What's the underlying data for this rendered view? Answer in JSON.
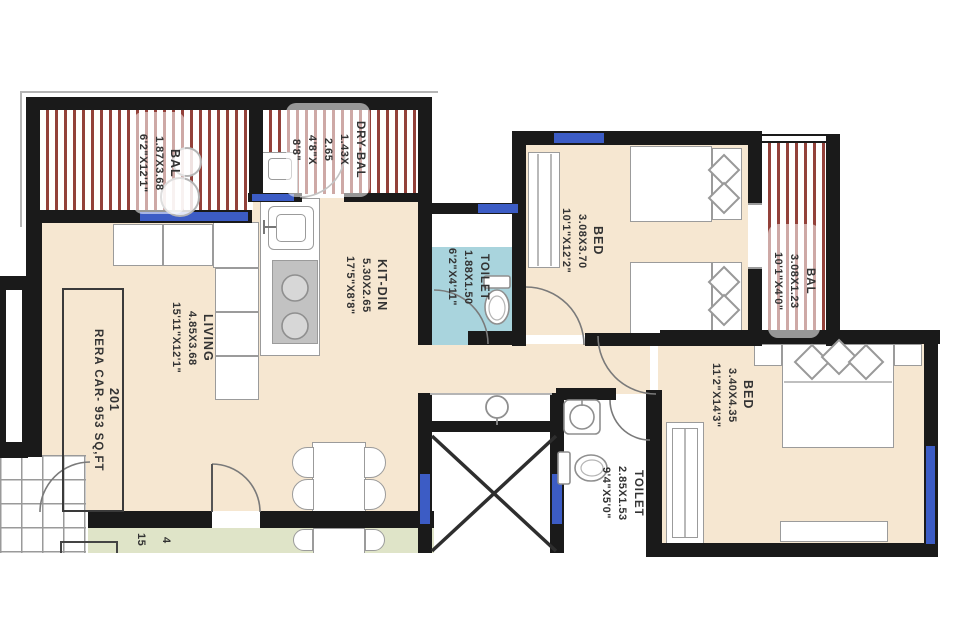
{
  "plan": {
    "unit_box": {
      "number": "201",
      "area": "RERA CAR- 953 SQ,FT"
    },
    "rooms": {
      "balcony_left": {
        "name": "BAL",
        "dim_m": "1.87X3.68",
        "dim_ft": "6'2\"X12'1\""
      },
      "dry_balcony": {
        "name": "DRY-BAL",
        "dim_m_a": "1.43X",
        "dim_m_b": "2.65",
        "dim_ft_a": "4'8\"X",
        "dim_ft_b": "8'8\""
      },
      "living": {
        "name": "LIVING",
        "dim_m": "4.85X3.68",
        "dim_ft": "15'11\"X12'1\""
      },
      "kitchen_dining": {
        "name": "KIT-DIN",
        "dim_m": "5.30X2.65",
        "dim_ft": "17'5\"X8'8\""
      },
      "toilet_common": {
        "name": "TOILET",
        "dim_m": "1.88X1.50",
        "dim_ft": "6'2\"X4'11\""
      },
      "bed_top": {
        "name": "BED",
        "dim_m": "3.08X3.70",
        "dim_ft": "10'1\"X12'2\""
      },
      "balcony_right": {
        "name": "BAL",
        "dim_m": "3.08X1.23",
        "dim_ft": "10'1\"X4'0\""
      },
      "bed_master": {
        "name": "BED",
        "dim_m": "3.40X4.35",
        "dim_ft": "11'2\"X14'3\""
      },
      "toilet_master": {
        "name": "TOILET",
        "dim_m": "2.85X1.53",
        "dim_ft": "9'4\"X5'0\""
      },
      "adjacent_unit": {
        "fragment_a": "15",
        "fragment_b": "4"
      }
    },
    "colors": {
      "floor": "#f6e7d1",
      "toilet_floor": "#a9d4dd",
      "adjacent_floor": "#dfe4c8",
      "balcony_stripe": "#93413a",
      "wall": "#1a1a1a",
      "window": "#3c5cc5",
      "furniture_line": "#9b9b9b"
    }
  }
}
